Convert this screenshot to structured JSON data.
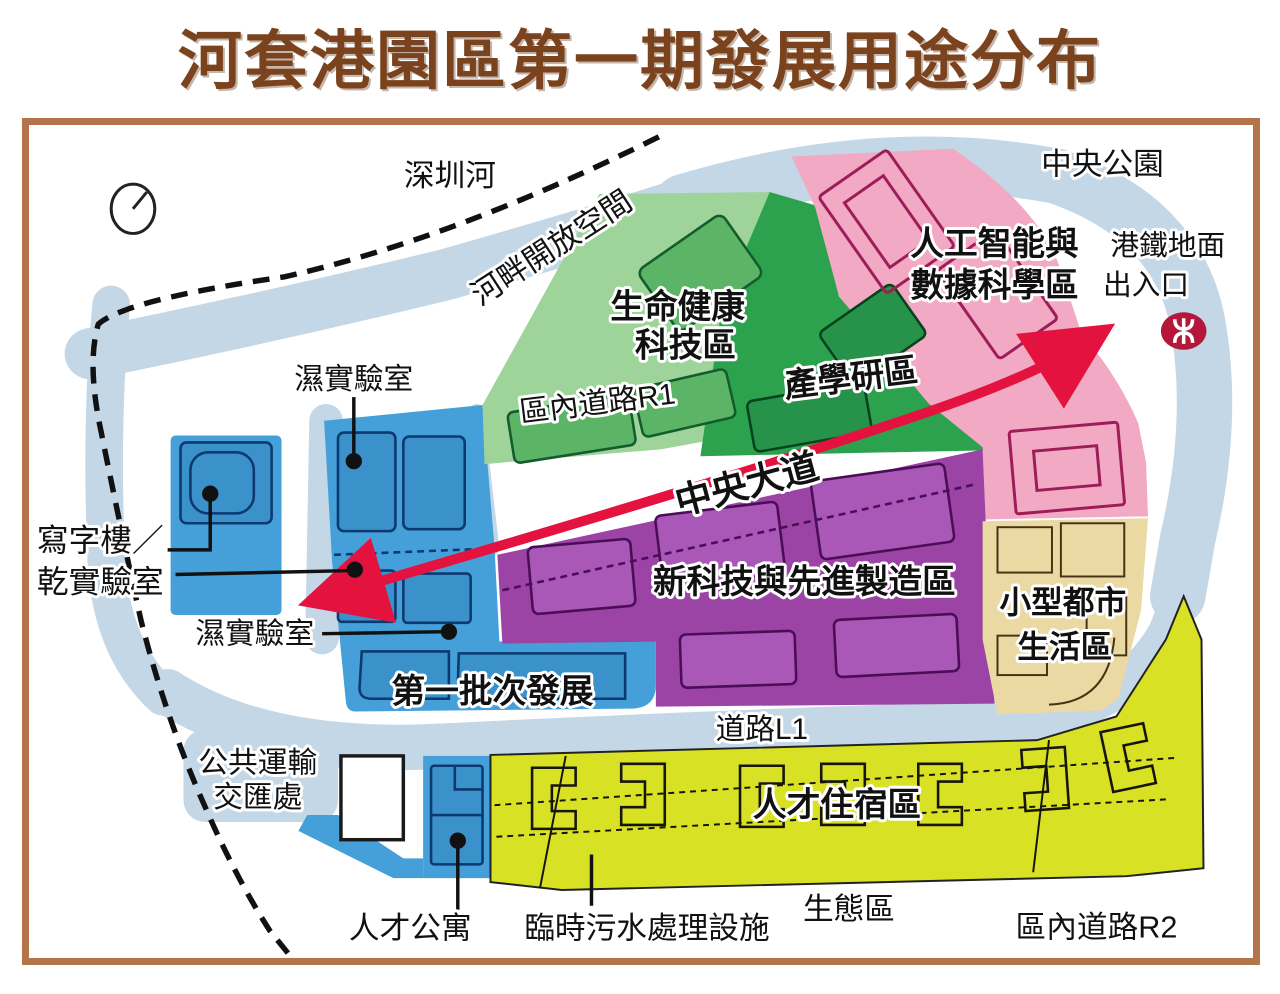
{
  "title": "河套港園區第一期發展用途分布",
  "colors": {
    "title_brown": "#7a431d",
    "frame_brown": "#b5734a",
    "road_blue": "#c3d7e7",
    "zone_blue": "#45a0d9",
    "zone_light_green": "#9ed49a",
    "zone_dark_green": "#2da24e",
    "zone_pink": "#f2a9c3",
    "zone_purple": "#9b44a5",
    "zone_tan": "#ebd9a4",
    "zone_yellow_green": "#d9e125",
    "arrow_red": "#e4123f",
    "mtr_red": "#b5173a"
  },
  "map": {
    "landmarks": {
      "shenzhen_river": "深圳河",
      "riverside_open_space": "河畔開放空間",
      "central_park": "中央公園",
      "mtr_entrance_line1": "港鐵地面",
      "mtr_entrance_line2": "出入口",
      "eco_zone": "生態區"
    },
    "zones": {
      "life_health_line1": "生命健康",
      "life_health_line2": "科技區",
      "industry_academia_research": "產學研區",
      "ai_data_line1": "人工智能與",
      "ai_data_line2": "數據科學區",
      "new_tech_manufacturing": "新科技與先進製造區",
      "small_urban_line1": "小型都市",
      "small_urban_line2": "生活區",
      "first_batch": "第一批次發展",
      "talent_housing": "人才住宿區"
    },
    "roads": {
      "district_road_r1": "區內道路R1",
      "central_avenue": "中央大道",
      "road_l1": "道路L1",
      "district_road_r2": "區內道路R2"
    },
    "callouts": {
      "wet_lab_top": "濕實驗室",
      "office_line1": "寫字樓／",
      "office_line2": "乾實驗室",
      "wet_lab_bottom": "濕實驗室",
      "transport_line1": "公共運輸",
      "transport_line2": "交匯處",
      "talent_apartment": "人才公寓",
      "sewage_facility": "臨時污水處理設施"
    },
    "icons": {
      "mtr": "mtr-logo",
      "north": "north-indicator"
    }
  }
}
